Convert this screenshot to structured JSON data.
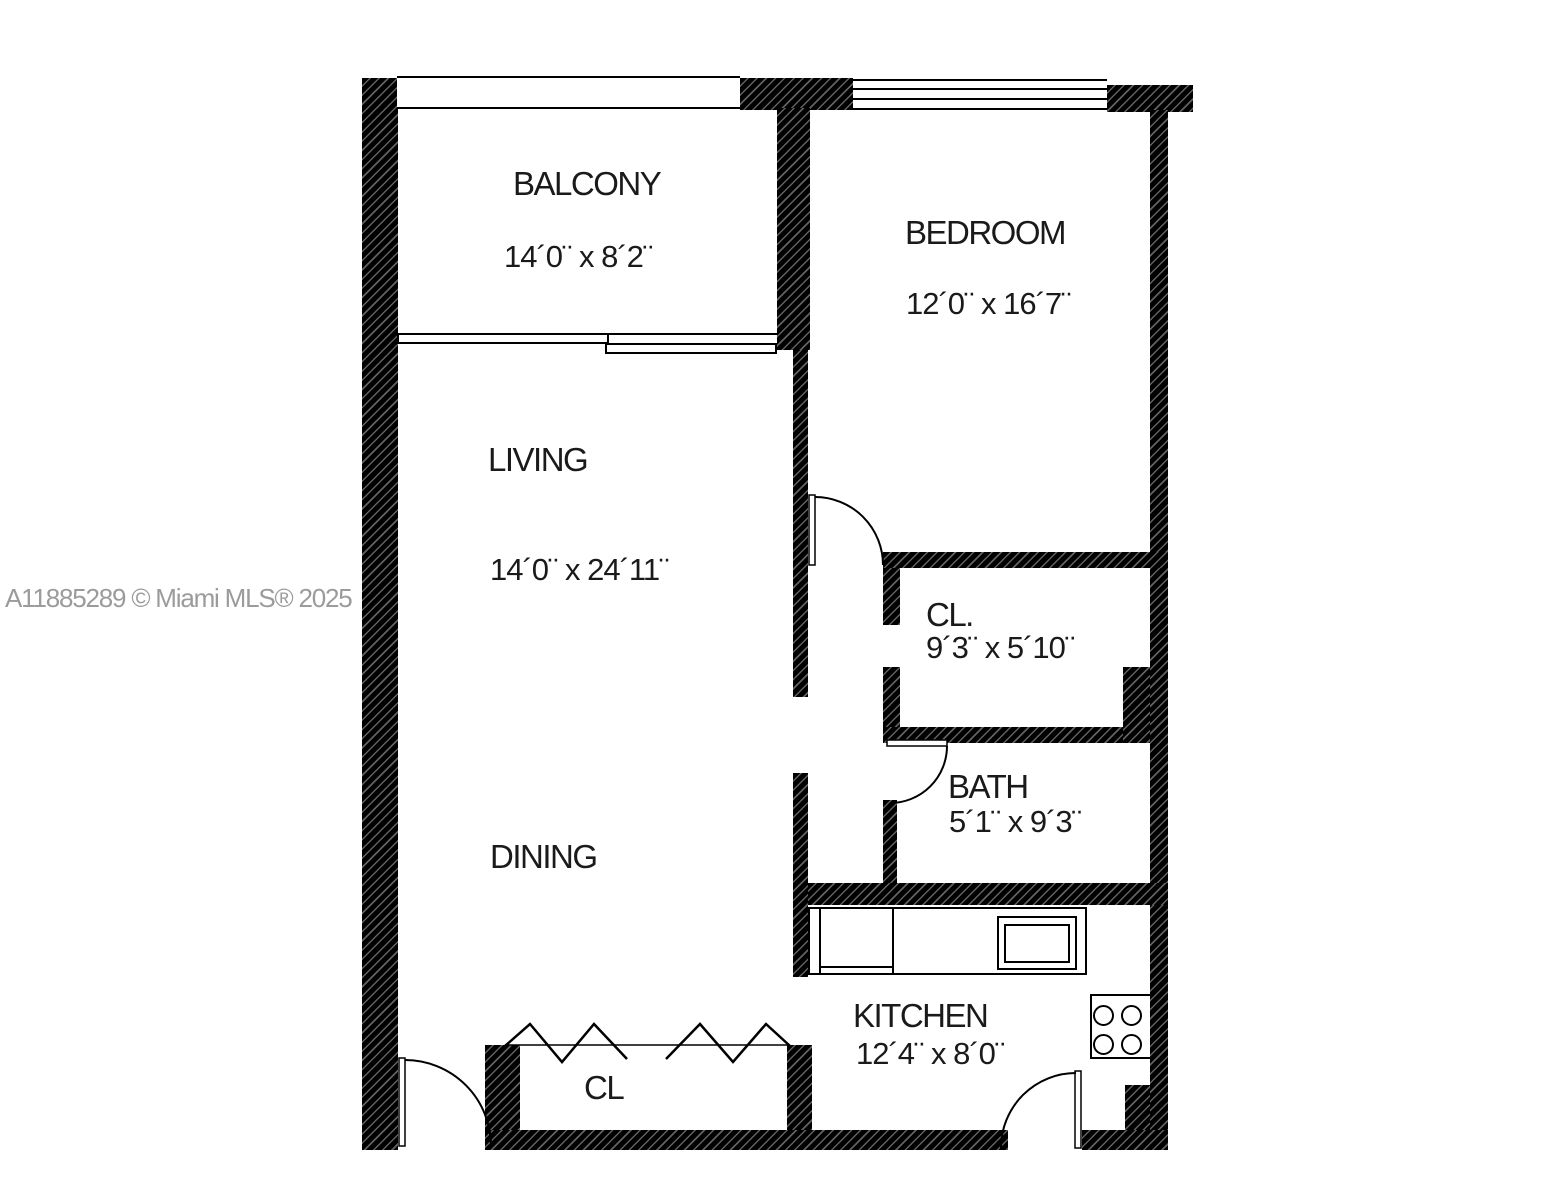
{
  "watermark": {
    "text": "A11885289 © Miami MLS® 2025"
  },
  "rooms": {
    "balcony": {
      "label": "BALCONY",
      "dims": "14´0¨ x 8´2¨"
    },
    "bedroom": {
      "label": "BEDROOM",
      "dims": "12´0¨ x 16´7¨"
    },
    "living": {
      "label": "LIVING",
      "dims": "14´0¨ x 24´11¨"
    },
    "dining": {
      "label": "DINING"
    },
    "closet1": {
      "label": "CL.",
      "dims": "9´3¨ x 5´10¨"
    },
    "bath": {
      "label": "BATH",
      "dims": "5´1¨ x 9´3¨"
    },
    "kitchen": {
      "label": "KITCHEN",
      "dims": "12´4¨ x 8´0¨"
    },
    "closet2": {
      "label": "CL"
    }
  },
  "colors": {
    "wall": "#000000",
    "hatch_line": "#ffffff",
    "text": "#1a1a1a",
    "watermark": "#9b9b9b",
    "background": "#ffffff"
  }
}
